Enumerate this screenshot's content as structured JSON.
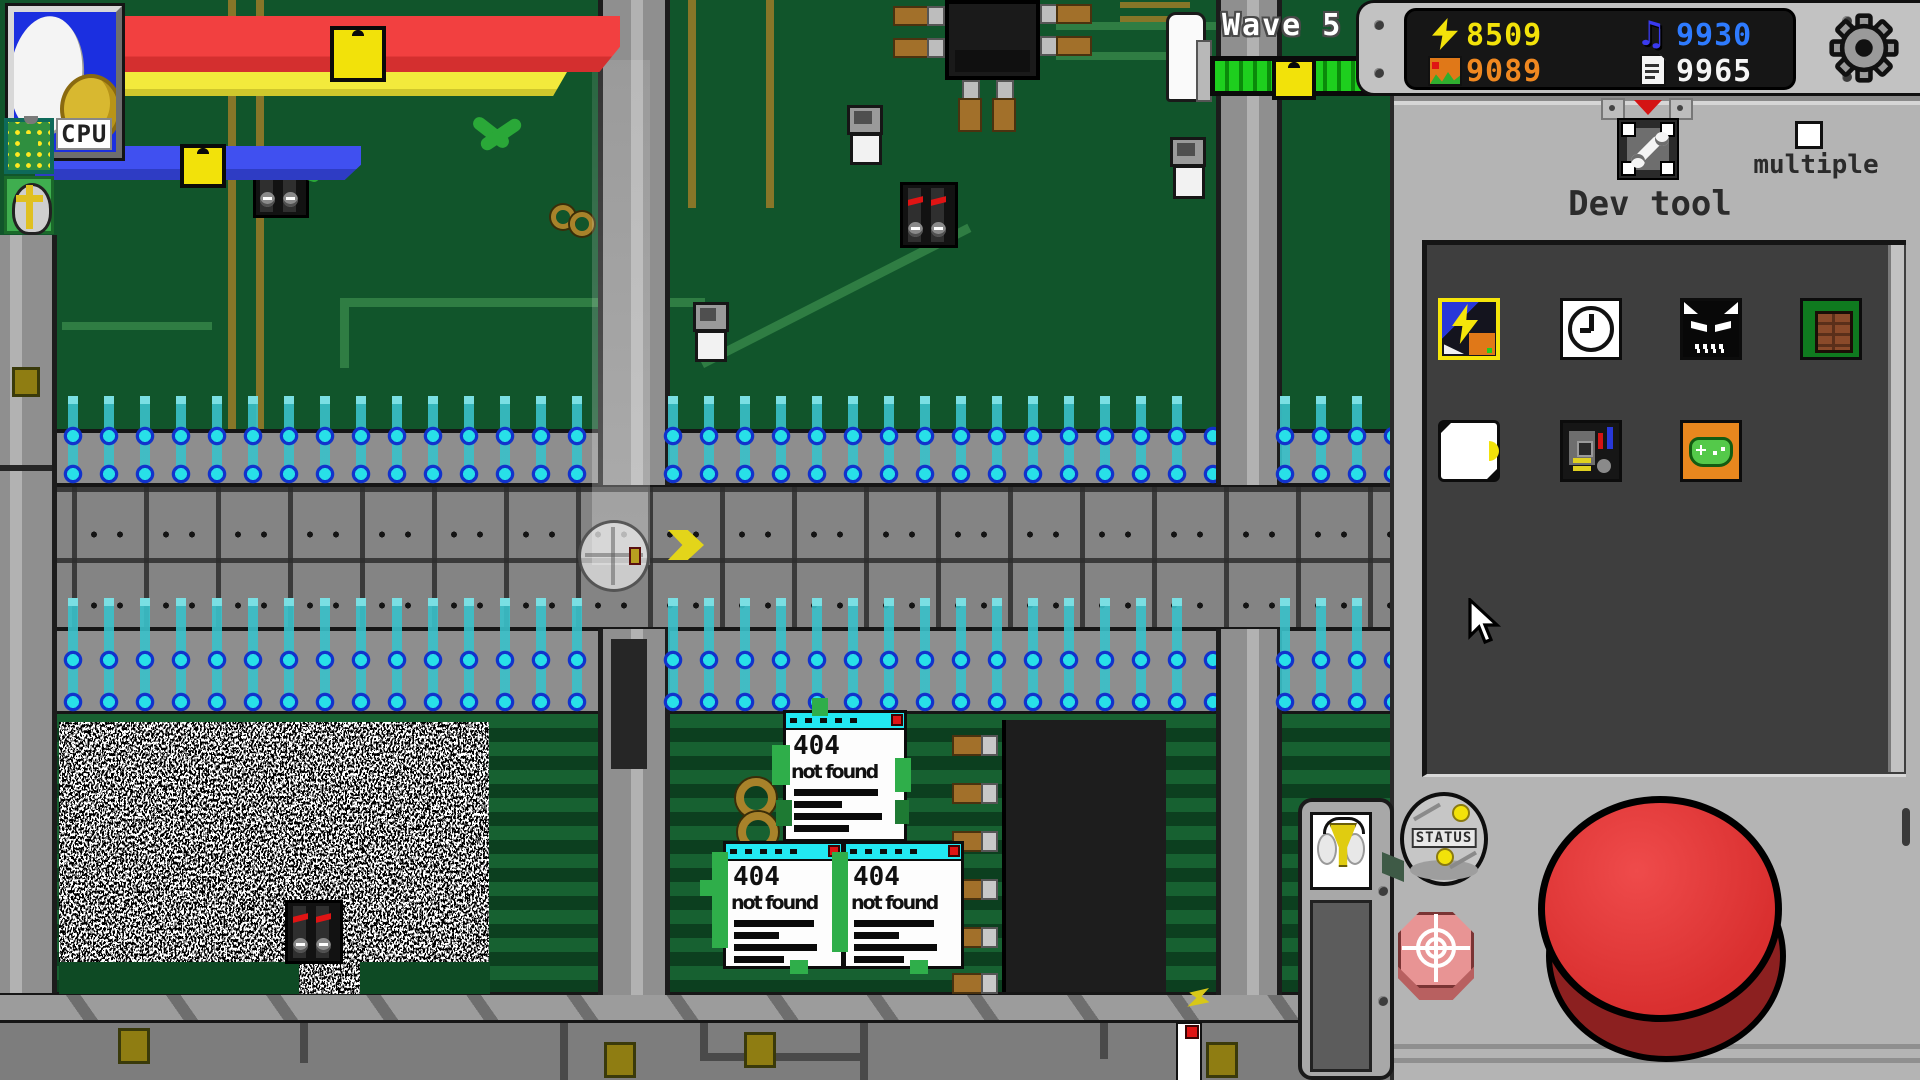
{
  "hud": {
    "cpu_label": "CPU",
    "wave_label": "Wave 5"
  },
  "resources": {
    "energy_value": "8509",
    "energy_color": "#f2e20a",
    "image_value": "9089",
    "image_color": "#f08820",
    "music_value": "9930",
    "music_color": "#2e7bff",
    "file_value": "9965",
    "file_color": "#f5f5f5"
  },
  "devtool": {
    "title": "Dev tool",
    "multiple_label": "multiple",
    "status_label": "STATUS",
    "tools": [
      {
        "name": "cheat-lightning-tool",
        "selected": true
      },
      {
        "name": "clock-tool",
        "selected": false
      },
      {
        "name": "demon-tool",
        "selected": false
      },
      {
        "name": "brick-wall-tool",
        "selected": false
      },
      {
        "name": "white-orb-tool",
        "selected": false
      },
      {
        "name": "circuit-scrap-tool",
        "selected": false
      },
      {
        "name": "gamepad-tool",
        "selected": false
      }
    ]
  },
  "popups": [
    {
      "code": "404",
      "message": "not found"
    },
    {
      "code": "404",
      "message": "not found"
    },
    {
      "code": "404",
      "message": "not found"
    }
  ],
  "colors": {
    "pcb_green": "#11552b",
    "road_gray": "#848484",
    "panel_gray": "#b4b4b4",
    "alert_red": "#d92f2f",
    "energy_cyan": "#28e0e8"
  }
}
